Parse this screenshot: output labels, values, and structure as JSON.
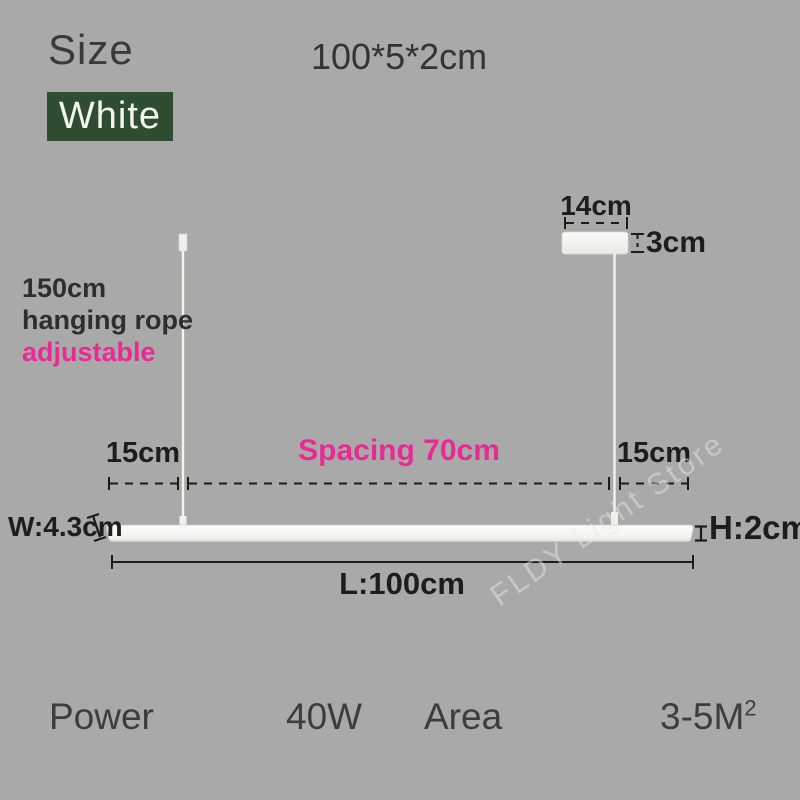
{
  "colors": {
    "background": "#a9a9a9",
    "badge_background": "#2f4d31",
    "badge_text": "#f3f6ef",
    "accent_pink": "#e82b93",
    "dimension_text": "#1d1d1d",
    "fixture_white": "#f6f6f4"
  },
  "header": {
    "size_label": "Size",
    "size_value": "100*5*2cm",
    "color_badge": "White"
  },
  "diagram": {
    "canopy": {
      "width_label": "14cm",
      "height_label": "3cm"
    },
    "rope_note": {
      "line1": "150cm",
      "line2": "hanging rope",
      "line3": "adjustable"
    },
    "spacing": {
      "left_label": "15cm",
      "center_label": "Spacing 70cm",
      "right_label": "15cm"
    },
    "bar": {
      "width_label": "W:4.3cm",
      "height_label": "H:2cm",
      "length_label": "L:100cm"
    },
    "watermark": "FLDY Light Store"
  },
  "specs": {
    "power_label": "Power",
    "power_value": "40W",
    "area_label": "Area",
    "area_value": "3-5M",
    "area_superscript": "2"
  }
}
